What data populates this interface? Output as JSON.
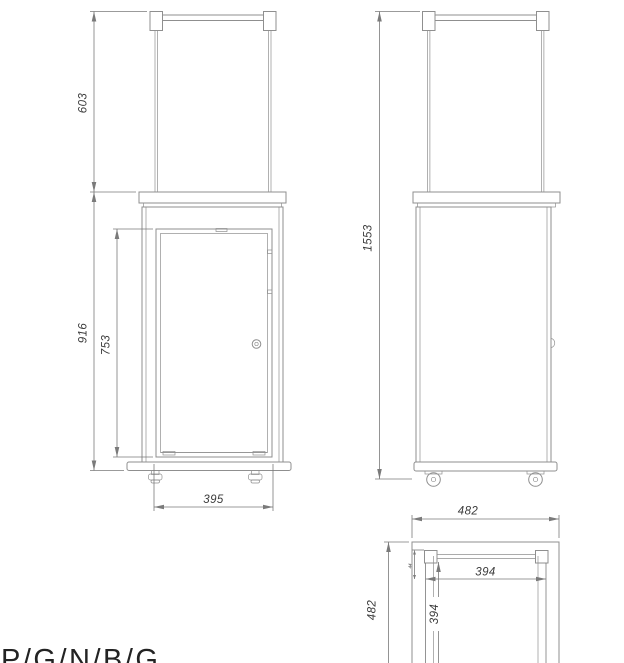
{
  "style": {
    "bg": "#ffffff",
    "line": "#8f8f8f",
    "dim": "#7a7a7a",
    "ink": "#3a3a3a",
    "label": "#232323"
  },
  "product_label": "P/G/N/B/G",
  "views": {
    "front": {
      "dims": {
        "upper_height": "603",
        "body_height": "916",
        "door_height": "753",
        "door_width": "395"
      }
    },
    "side": {
      "dims": {
        "overall_height": "1553"
      }
    },
    "top": {
      "dims": {
        "overall_width": "482",
        "overall_depth": "482",
        "handle_span_width": "394",
        "handle_span_depth": "394",
        "corner_offset": "44"
      }
    }
  }
}
